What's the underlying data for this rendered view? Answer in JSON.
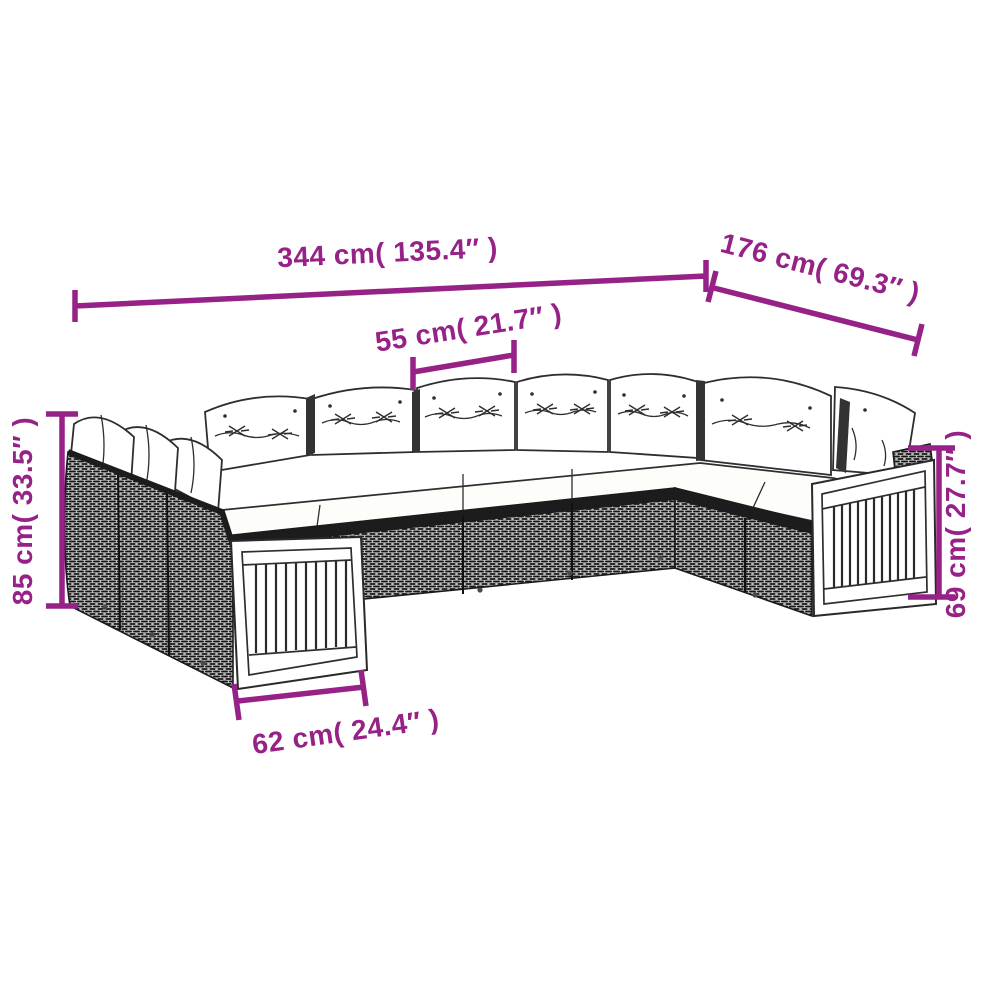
{
  "description": "Dimension diagram line drawing of a U-shaped poly rattan garden sofa set with white tufted cushions and wood slat end panels",
  "colors": {
    "dimension_accent": "#962187",
    "outline": "#2e2e2e",
    "background": "#ffffff"
  },
  "dimensions": {
    "overall_width": "344 cm( 135.4″ )",
    "right_depth": "176 cm( 69.3″ )",
    "seat_width": "55 cm( 21.7″ )",
    "back_height": "85 cm( 33.5″ )",
    "arm_height": "69 cm( 27.7″ )",
    "module_depth": "62 cm( 24.4″ )"
  }
}
